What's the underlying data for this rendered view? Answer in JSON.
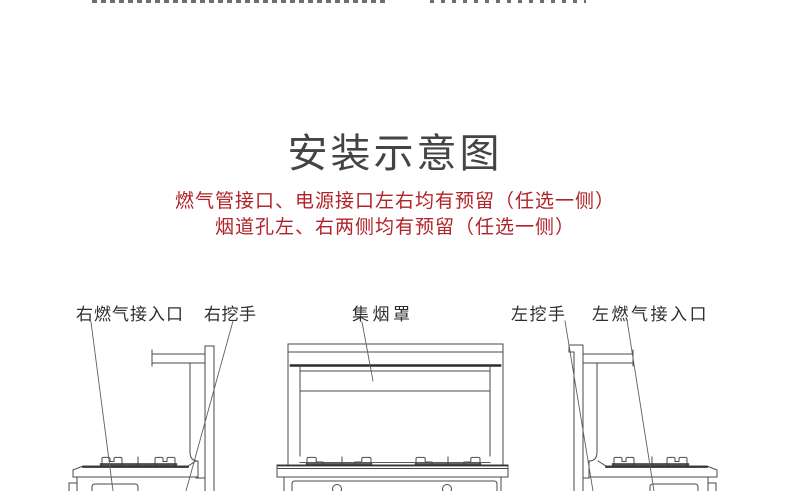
{
  "page": {
    "background": "#ffffff"
  },
  "header": {
    "title": "安装示意图",
    "title_color": "#444444"
  },
  "notes": {
    "color": "#b02328",
    "lines": [
      "燃气管接口、电源接口左右均有预留（任选一侧）",
      "烟道孔左、右两侧均有预留（任选一侧）"
    ]
  },
  "diagram": {
    "stroke_color": "#4a4a4a",
    "labels": [
      {
        "id": "right-gas-inlet",
        "text": "右燃气接入口"
      },
      {
        "id": "right-grip-handle",
        "text": "右挖手"
      },
      {
        "id": "smoke-collecting-hood",
        "text": "集烟罩"
      },
      {
        "id": "left-grip-handle",
        "text": "左挖手"
      },
      {
        "id": "left-gas-inlet",
        "text": "左燃气接入口"
      }
    ]
  }
}
